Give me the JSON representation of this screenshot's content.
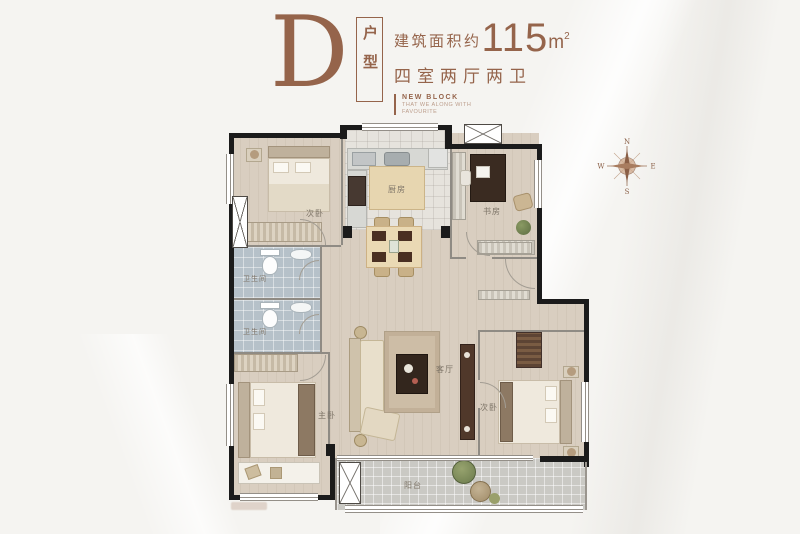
{
  "header": {
    "letter": "D",
    "type_label": "户型",
    "area_prefix": "建筑面积约",
    "area_value": "115",
    "area_unit": "m",
    "area_unit_sup": "2",
    "layout_desc": "四室两厅两卫",
    "block_title": "NEW BLOCK",
    "block_tagline_line1": "THAT WE ALONG WITH",
    "block_tagline_line2": "FAVOURITE"
  },
  "compass": {
    "north": "N",
    "east": "E",
    "south": "S",
    "west": "W"
  },
  "plan": {
    "rooms": {
      "bedroom_top_left": "次卧",
      "kitchen": "厨房",
      "study": "书房",
      "bathroom_upper": "卫生间",
      "bathroom_lower": "卫生间",
      "master_bedroom": "主卧",
      "living_room": "客厅",
      "bedroom_bottom_right": "次卧",
      "balcony": "阳台"
    }
  },
  "colors": {
    "accent": "#95644b",
    "wall": "#1b1b1b",
    "wood_floor": "#d9cec0",
    "bath_tile": "#b6c1c9",
    "balcony_tile": "#cac9c4"
  }
}
